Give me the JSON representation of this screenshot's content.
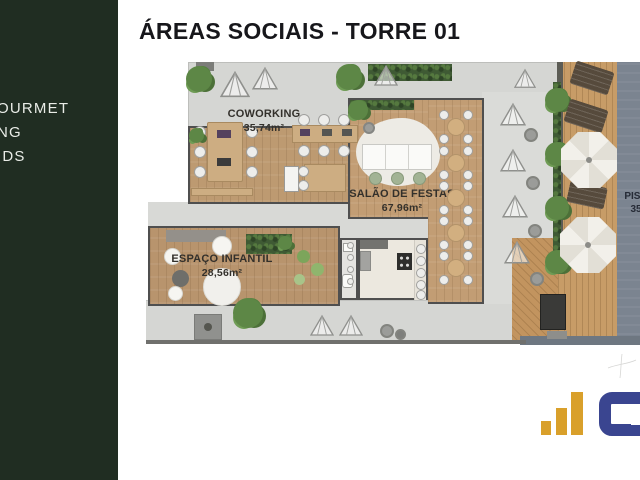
{
  "sidebar": {
    "bg_color": "#202d22",
    "items": [
      {
        "label": "OURMET"
      },
      {
        "label": "NG"
      },
      {
        "label": "IDS"
      }
    ]
  },
  "header": {
    "title": "ÁREAS SOCIAIS - TORRE 01"
  },
  "plan": {
    "rooms": {
      "coworking": {
        "name": "COWORKING",
        "area": "35,74m²"
      },
      "salao": {
        "name": "SALÃO DE FESTAS",
        "area": "67,96m²"
      },
      "infantil": {
        "name": "ESPAÇO INFANTIL",
        "area": "28,56m²"
      },
      "piscina": {
        "name": "PISC",
        "area": "35"
      }
    },
    "colors": {
      "terrace": "#d5d6d3",
      "wood": "#bd9a71",
      "deck": "#c79c67",
      "pool": "#7b8490",
      "hedge": "#3f5a34"
    }
  },
  "logo": {
    "bar_color": "#d9a02b",
    "letter_color": "#3a4590"
  }
}
